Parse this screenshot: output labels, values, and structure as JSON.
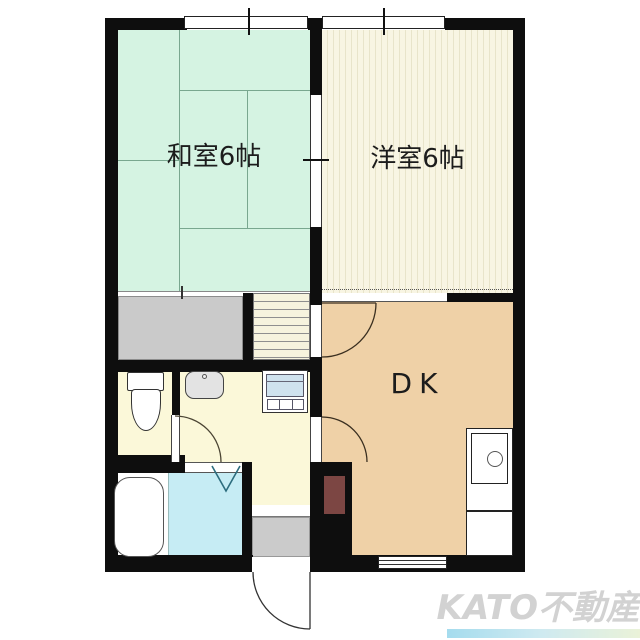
{
  "floorplan": {
    "type": "japanese-apartment-floor-plan",
    "rooms": {
      "japanese_room": {
        "label": "和室6帖",
        "color": "#d5f3e2"
      },
      "western_room": {
        "label": "洋室6帖",
        "color": "#f8f5e3"
      },
      "dining_kitchen": {
        "label": "DK",
        "color": "#efd1a7"
      },
      "washroom": {
        "color": "#fbf8d9"
      },
      "toilet_room": {
        "color": "#fbf8d9"
      },
      "bathroom": {
        "color": "#c6ecf4"
      },
      "closet": {
        "color": "#cacaca"
      },
      "entrance": {
        "color": "#cbcbcb"
      }
    },
    "fixtures": [
      "bathtub",
      "toilet",
      "washbasin",
      "washing-machine",
      "kitchen-counter",
      "kitchen-sink",
      "staircase",
      "refrigerator-space",
      "entrance-door",
      "folding-bath-door"
    ],
    "wall_color": "#0e0e0e",
    "watermark": {
      "text": "KATO不動産",
      "text_color": "#d2d2d2",
      "underline_gradient": [
        "#a5dcee",
        "#eaf2d8"
      ]
    }
  }
}
